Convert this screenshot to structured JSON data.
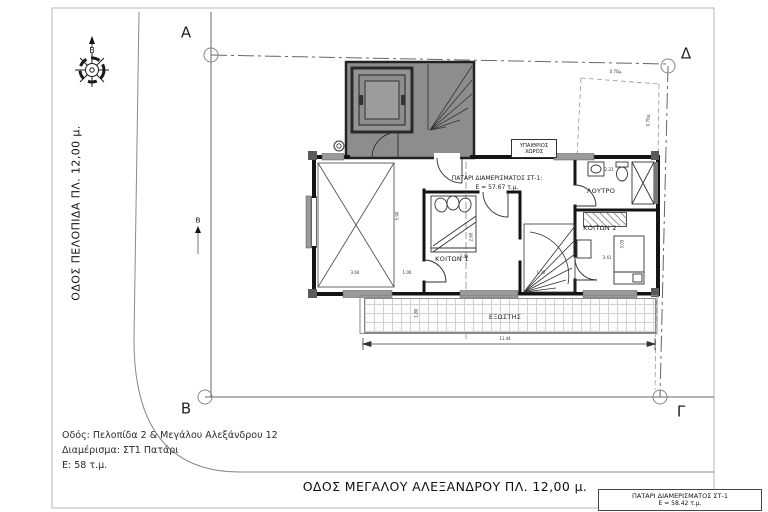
{
  "colors": {
    "paper": "#ffffff",
    "boundary_line": "#666666",
    "wall": "#141414",
    "core_fill": "#8d8d8d",
    "tile_line": "#d2d2d2"
  },
  "compass": {
    "north_label": "Β"
  },
  "boundary": {
    "corner_a": "Α",
    "corner_b": "Β",
    "corner_g": "Γ",
    "corner_d": "Δ"
  },
  "section_marker": {
    "label": "Β"
  },
  "streets": {
    "left": "ΟΔΟΣ ΠΕΛΟΠΙΔΑ ΠΛ. 12,00 μ.",
    "bottom": "ΟΔΟΣ ΜΕΓΑΛΟΥ ΑΛΕΞΑΝΔΡΟΥ ΠΛ. 12,00 μ."
  },
  "info_block": {
    "line1": "Οδός: Πελοπίδα 2 & Μεγάλου Αλεξάνδρου 12",
    "line2": "Διαμέρισμα: ΣΤ1 Πατάρι",
    "line3": "Ε: 58 τ.μ."
  },
  "title_box": {
    "line1": "ΠΑΤΑΡΙ ΔΙΑΜΕΡΙΣΜΑΤΟΣ ΣΤ-1",
    "line2": "Ε = 58.42 τ.μ."
  },
  "plan": {
    "apartment": {
      "line1": "ΠΑΤΑΡΙ ΔΙΑΜΕΡΙΣΜΑΤΟΣ ΣΤ-1:",
      "line2": "Ε = 57.67 τ.μ."
    },
    "rooms": {
      "open_air_1": "ΥΠΑΙΘΡΙΟΣ",
      "open_air_2": "ΧΩΡΟΣ",
      "bathroom": "ΛΟΥΤΡΟ",
      "bedroom1": "ΚΟΙΤΩΝ 1",
      "bedroom2": "ΚΟΙΤΩΝ 2",
      "balcony": "ΕΞΩΣΤΗΣ"
    },
    "dims": {
      "void_w": "3.60",
      "corridor_w": "1.00",
      "void_h": "5.90",
      "bed1_w": "3.48",
      "bed1_h": "2.60",
      "stair_w": "1.30",
      "bed2_w": "3.41",
      "bed2_h": "3.05",
      "bath_w": "2.23",
      "balcony_w": "11.44",
      "balcony_d": "1.80",
      "lift_w": "1.00",
      "setback_top": "0.70μ.",
      "setback_right": "0.70μ."
    }
  }
}
